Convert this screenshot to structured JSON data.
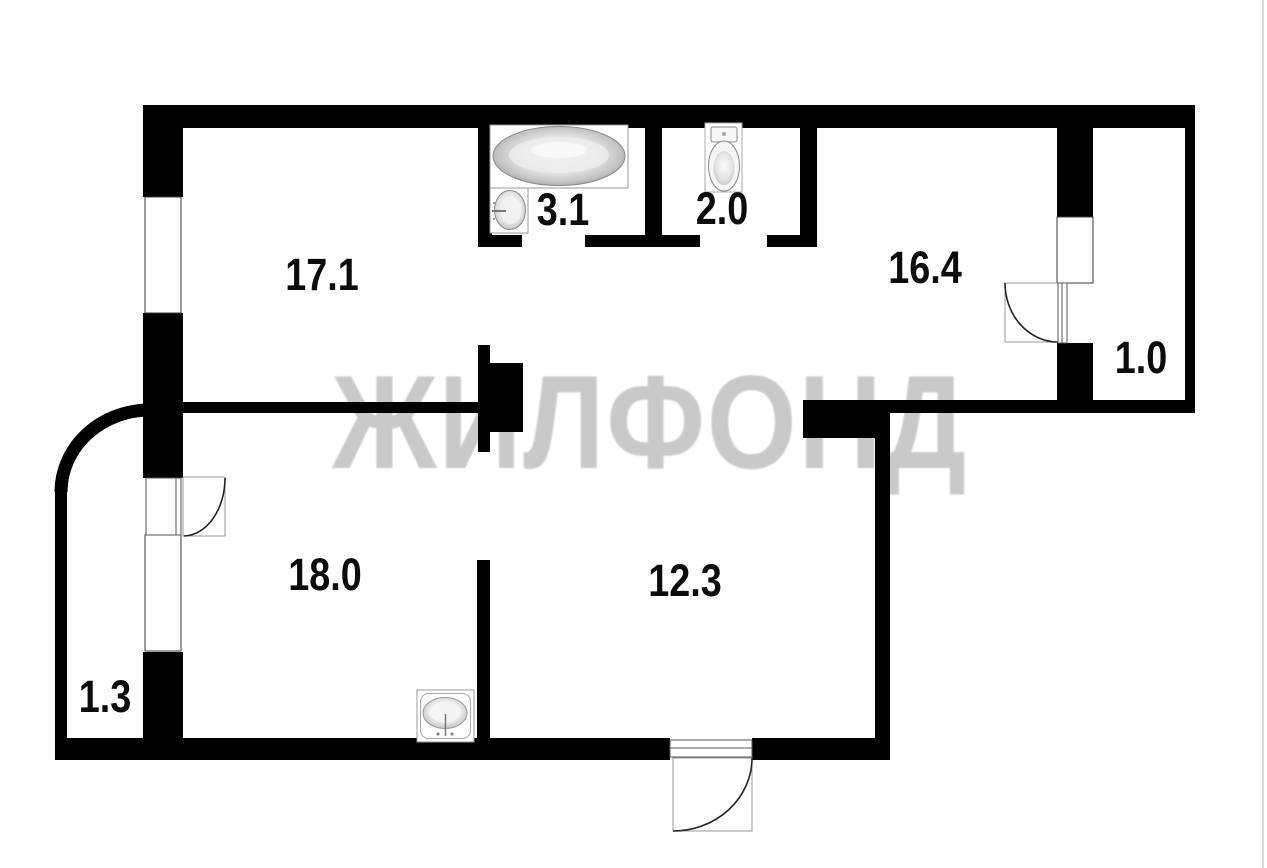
{
  "watermark": {
    "text": "ЖИЛФОНД",
    "color": "#c9c9c9"
  },
  "rooms": [
    {
      "name": "room-top-left",
      "area": "17.1"
    },
    {
      "name": "bathroom",
      "area": "3.1"
    },
    {
      "name": "toilet-room",
      "area": "2.0"
    },
    {
      "name": "room-top-right",
      "area": "16.4"
    },
    {
      "name": "balcony-right",
      "area": "1.0"
    },
    {
      "name": "room-bottom-left",
      "area": "18.0"
    },
    {
      "name": "room-bottom-mid",
      "area": "12.3"
    },
    {
      "name": "balcony-left",
      "area": "1.3"
    }
  ],
  "fixtures": [
    "bathtub-icon",
    "bathroom-sink-icon",
    "toilet-icon",
    "kitchen-sink-icon"
  ],
  "colors": {
    "wall": "#000000",
    "background": "#ffffff",
    "label": "#0c0c0c",
    "watermark": "#c9c9c9"
  }
}
